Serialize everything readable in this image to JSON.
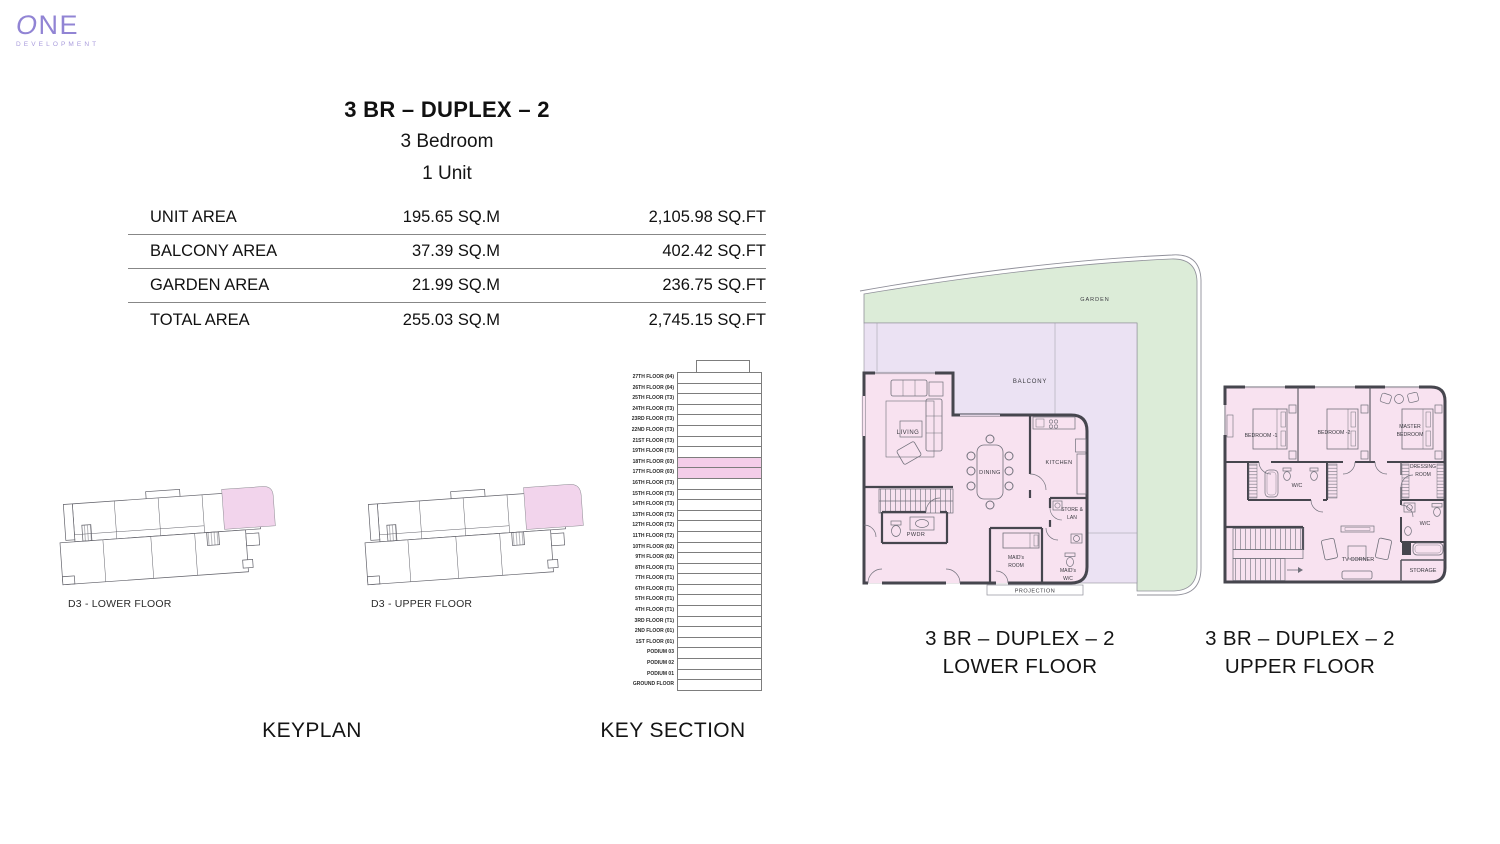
{
  "brand": {
    "logo_main": "ONE",
    "logo_sub": "DEVELOPMENT",
    "accent_color": "#9184d4"
  },
  "header": {
    "title": "3 BR – DUPLEX – 2",
    "subtitle_bedrooms": "3 Bedroom",
    "subtitle_units": "1 Unit"
  },
  "area_table": {
    "rows": [
      {
        "label": "UNIT AREA",
        "sqm": "195.65 SQ.M",
        "sqft": "2,105.98 SQ.FT"
      },
      {
        "label": "BALCONY AREA",
        "sqm": "37.39 SQ.M",
        "sqft": "402.42 SQ.FT"
      },
      {
        "label": "GARDEN AREA",
        "sqm": "21.99 SQ.M",
        "sqft": "236.75 SQ.FT"
      },
      {
        "label": "TOTAL AREA",
        "sqm": "255.03 SQ.M",
        "sqft": "2,745.15 SQ.FT"
      }
    ]
  },
  "keyplan": {
    "caption": "KEYPLAN",
    "lower_label": "D3 - LOWER FLOOR",
    "upper_label": "D3 - UPPER FLOOR"
  },
  "key_section": {
    "caption": "KEY SECTION",
    "floors": [
      {
        "label": "27TH FLOOR (04)",
        "hl": false
      },
      {
        "label": "26TH FLOOR (04)",
        "hl": false
      },
      {
        "label": "25TH FLOOR (T3)",
        "hl": false
      },
      {
        "label": "24TH FLOOR (T3)",
        "hl": false
      },
      {
        "label": "23RD FLOOR (T3)",
        "hl": false
      },
      {
        "label": "22ND FLOOR (T3)",
        "hl": false
      },
      {
        "label": "21ST FLOOR (T3)",
        "hl": false
      },
      {
        "label": "19TH FLOOR (T3)",
        "hl": false
      },
      {
        "label": "18TH FLOOR (03)",
        "hl": true
      },
      {
        "label": "17TH FLOOR (03)",
        "hl": true
      },
      {
        "label": "16TH FLOOR (T3)",
        "hl": false
      },
      {
        "label": "15TH FLOOR (T3)",
        "hl": false
      },
      {
        "label": "14TH FLOOR (T3)",
        "hl": false
      },
      {
        "label": "13TH FLOOR (T2)",
        "hl": false
      },
      {
        "label": "12TH FLOOR (T2)",
        "hl": false
      },
      {
        "label": "11TH FLOOR (T2)",
        "hl": false
      },
      {
        "label": "10TH FLOOR (02)",
        "hl": false
      },
      {
        "label": "9TH FLOOR (02)",
        "hl": false
      },
      {
        "label": "8TH FLOOR (T1)",
        "hl": false
      },
      {
        "label": "7TH FLOOR (T1)",
        "hl": false
      },
      {
        "label": "6TH FLOOR (T1)",
        "hl": false
      },
      {
        "label": "5TH FLOOR (T1)",
        "hl": false
      },
      {
        "label": "4TH FLOOR (T1)",
        "hl": false
      },
      {
        "label": "3RD FLOOR (T1)",
        "hl": false
      },
      {
        "label": "2ND FLOOR (01)",
        "hl": false
      },
      {
        "label": "1ST FLOOR (01)",
        "hl": false
      },
      {
        "label": "PODIUM 03",
        "hl": false
      },
      {
        "label": "PODIUM 02",
        "hl": false
      },
      {
        "label": "PODIUM 01",
        "hl": false
      },
      {
        "label": "GROUND FLOOR",
        "hl": false
      }
    ]
  },
  "lower_plan": {
    "caption_line1": "3 BR – DUPLEX – 2",
    "caption_line2": "LOWER FLOOR",
    "labels": {
      "garden": "GARDEN",
      "balcony": "BALCONY",
      "living": "LIVING",
      "dining": "DINING",
      "kitchen": "KITCHEN",
      "pwdr": "PWDR",
      "store_line1": "STORE &",
      "store_line2": "LAN",
      "maids_room_line1": "MAID's",
      "maids_room_line2": "ROOM",
      "maids_wc_line1": "MAID's",
      "maids_wc_line2": "W/C",
      "projection": "PROJECTION"
    }
  },
  "upper_plan": {
    "caption_line1": "3 BR – DUPLEX – 2",
    "caption_line2": "UPPER FLOOR",
    "labels": {
      "bedroom1": "BEDROOM -1",
      "bedroom2": "BEDROOM -2",
      "master_line1": "MASTER",
      "master_line2": "BEDROOM",
      "dressing_line1": "DRESSING",
      "dressing_line2": "ROOM",
      "wc_top": "W/C",
      "wc_right": "W/C",
      "tv_corner": "TV CORNER",
      "storage": "STORAGE"
    }
  },
  "colors": {
    "unit_fill": "#f8e2f0",
    "balcony_fill": "#ebe2f3",
    "garden_fill": "#dcecd8",
    "highlight_pink": "#f4cde9",
    "wall": "#46464e"
  }
}
